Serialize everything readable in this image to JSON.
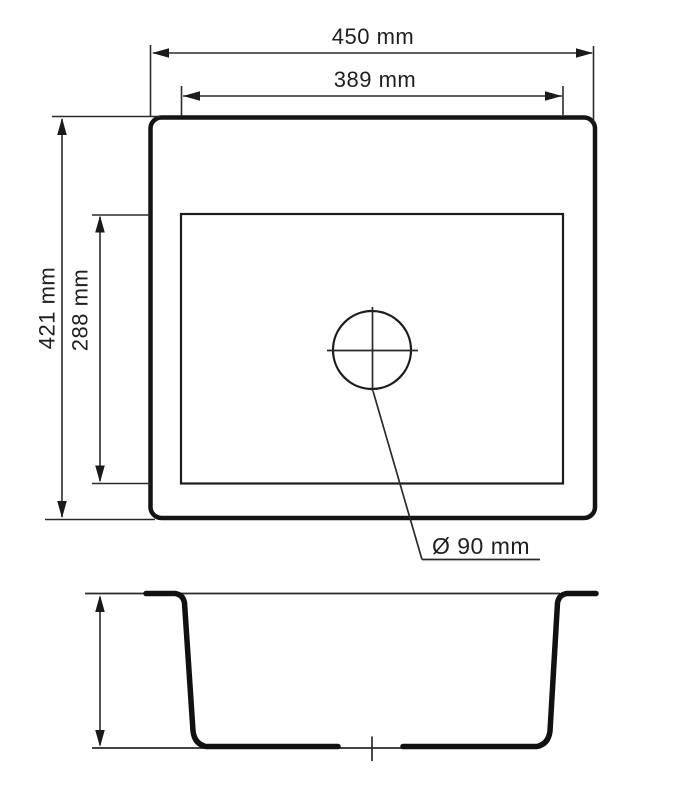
{
  "drawing": {
    "labels": {
      "overall_width": "450 mm",
      "bowl_width": "389 mm",
      "overall_depth": "421 mm",
      "bowl_depth": "288 mm",
      "drain_diameter": "Ø 90 mm"
    },
    "values": {
      "overall_width_mm": 450,
      "bowl_width_mm": 389,
      "overall_depth_mm": 421,
      "bowl_depth_mm": 288,
      "drain_diameter_mm": 90
    },
    "colors": {
      "line": "#1c1c1c",
      "background": "#ffffff"
    }
  }
}
